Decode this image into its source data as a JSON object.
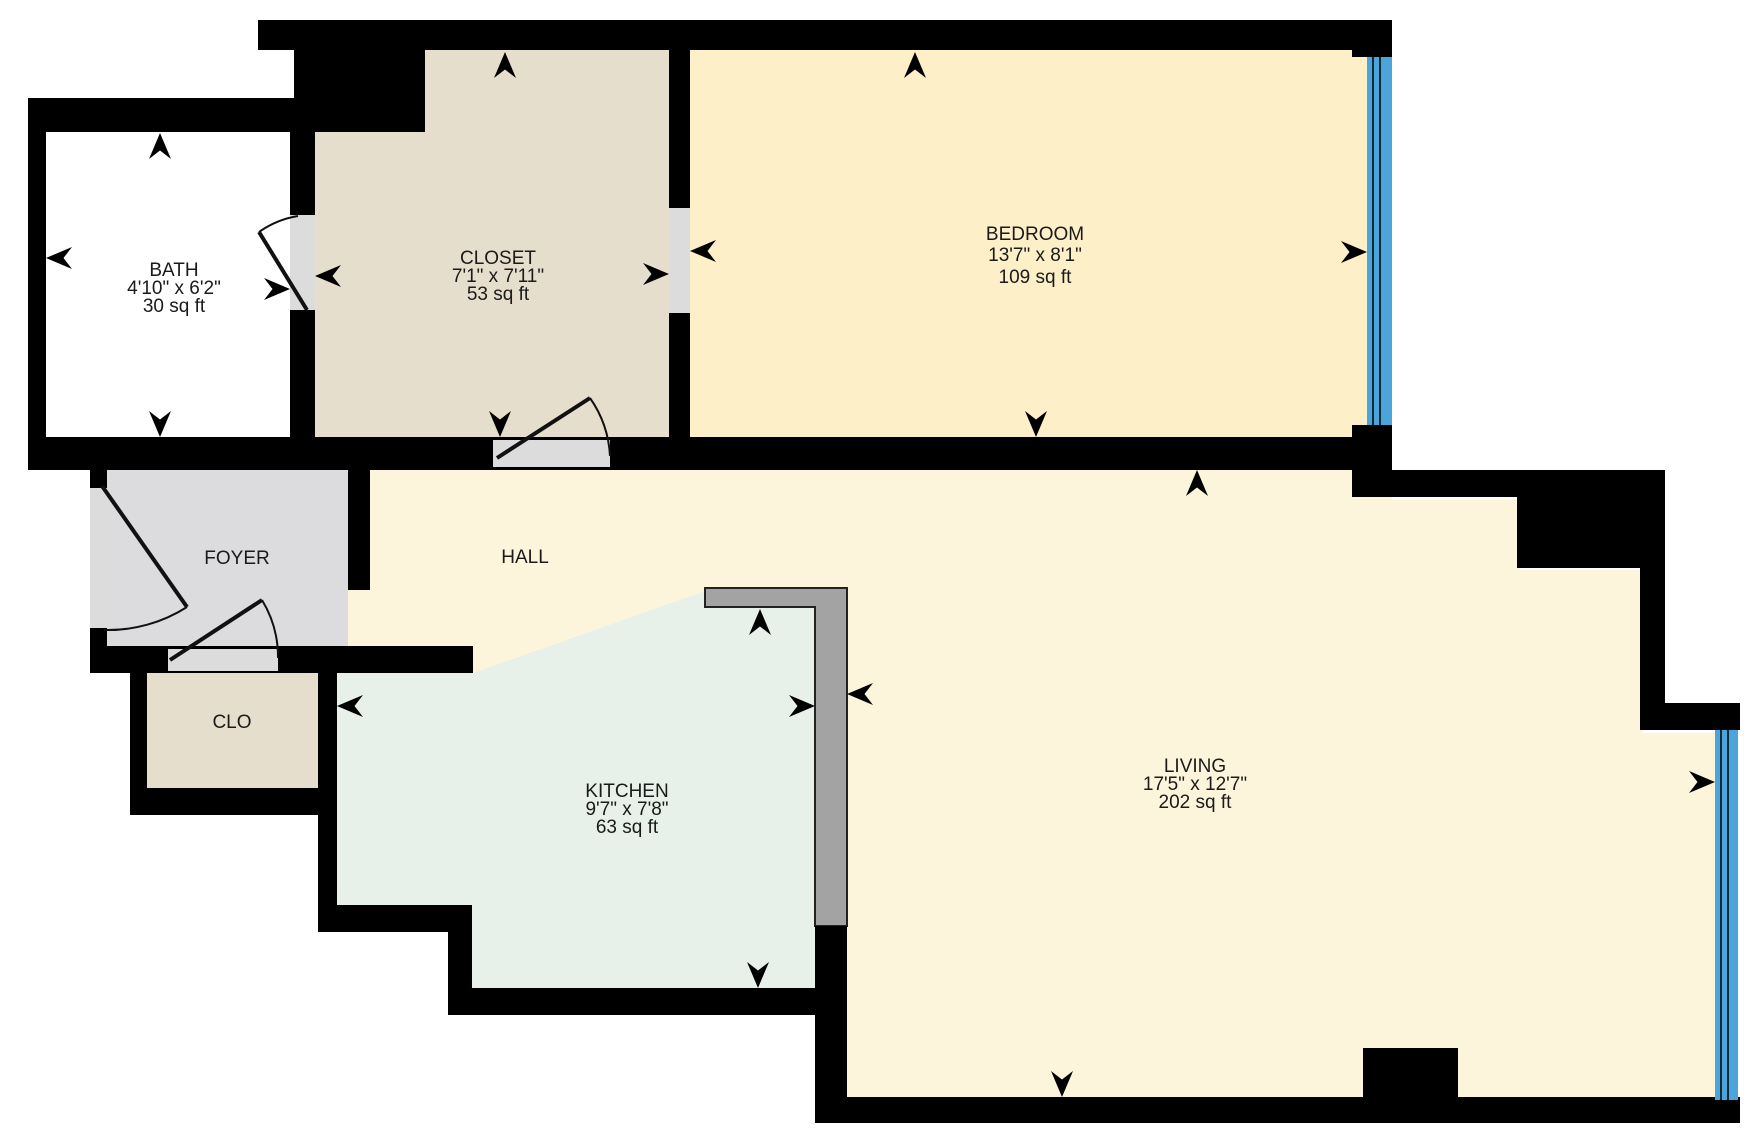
{
  "title": "Apartment floor plan",
  "rooms": [
    {
      "id": "bath",
      "label": "BATH",
      "dimensions": "4'10\" x 6'2\"",
      "area": "30 sq ft",
      "color": "#ffffff"
    },
    {
      "id": "closet",
      "label": "CLOSET",
      "dimensions": "7'1\" x 7'11\"",
      "area": "53 sq ft",
      "color": "#e6decd"
    },
    {
      "id": "bedroom",
      "label": "BEDROOM",
      "dimensions": "13'7\" x 8'1\"",
      "area": "109 sq ft",
      "color": "#fdefc7"
    },
    {
      "id": "foyer",
      "label": "FOYER",
      "color": "#dcdcde"
    },
    {
      "id": "hall",
      "label": "HALL",
      "color": "#fdf5db"
    },
    {
      "id": "clo",
      "label": "CLO",
      "color": "#e6decd"
    },
    {
      "id": "kitchen",
      "label": "KITCHEN",
      "dimensions": "9'7\" x 7'8\"",
      "area": "63 sq ft",
      "color": "#e7f0e9"
    },
    {
      "id": "living",
      "label": "LIVING",
      "dimensions": "17'5\" x 12'7\"",
      "area": "202 sq ft",
      "color": "#fdf5db"
    }
  ],
  "palette": {
    "wall": "#000000",
    "door_opening": "#dcdcdc",
    "counter": "#a3a3a3",
    "counter_border": "#222222",
    "window": "#4ba5da",
    "text": "#1a1a1a"
  }
}
